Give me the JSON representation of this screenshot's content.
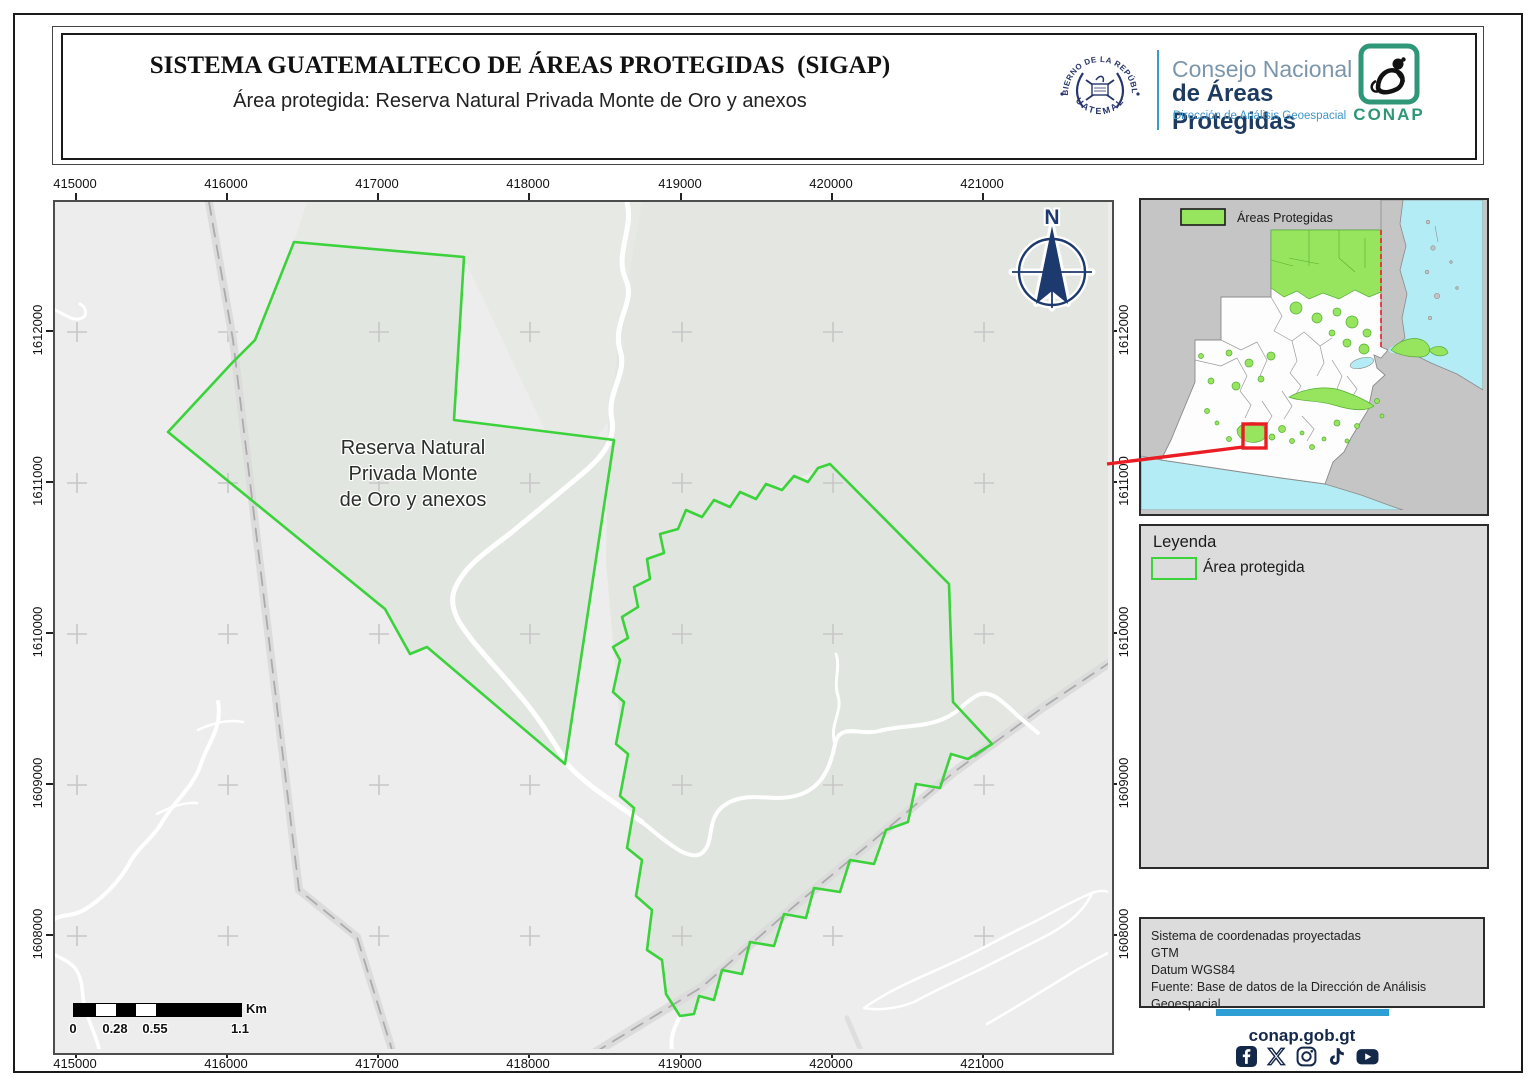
{
  "header": {
    "title": "SISTEMA GUATEMALTECO DE ÁREAS PROTEGIDAS  (SIGAP)",
    "subtitle": "Área protegida: Reserva Natural Privada Monte de Oro y anexos",
    "gov_seal_top": "GOBIERNO DE LA REPÚBLICA",
    "gov_seal_bottom": "GUATEMALA",
    "conap_line1": "Consejo Nacional",
    "conap_line2": "de Áreas Protegidas",
    "conap_line3": "Dirección de Análisis Geoespacial",
    "conap_acronym": "CONAP"
  },
  "map": {
    "x_ticks": [
      "415000",
      "416000",
      "417000",
      "418000",
      "419000",
      "420000",
      "421000"
    ],
    "y_ticks": [
      "1612000",
      "1611000",
      "1610000",
      "1609000",
      "1608000"
    ],
    "area_label_lines": [
      "Reserva Natural",
      "Privada Monte",
      "de Oro y anexos"
    ],
    "north_label": "N",
    "scale_bar": {
      "labels": [
        "0",
        "0.28",
        "0.55",
        "1.1"
      ],
      "unit": "Km"
    }
  },
  "inset_map": {
    "legend_label": "Áreas Protegidas"
  },
  "legend_panel": {
    "title": "Leyenda",
    "items": [
      {
        "label": "Área protegida",
        "swatch": "green-outline-rectangle"
      }
    ]
  },
  "info_panel": {
    "lines": [
      "Sistema de coordenadas proyectadas",
      "GTM",
      "Datum WGS84",
      "Fuente: Base de datos de la Dirección de Análisis Geoespacial"
    ]
  },
  "footer": {
    "website": "conap.gob.gt",
    "social_icons": [
      "facebook-icon",
      "x-icon",
      "instagram-icon",
      "tiktok-icon",
      "youtube-icon"
    ]
  },
  "colors": {
    "protected_outline": "#3bd23b",
    "inset_protected_fill": "#97e55e",
    "sea": "#b3ecf5",
    "accent_blue": "#2e9fd4",
    "navy": "#14284a",
    "locator_red": "#ea1c24"
  }
}
